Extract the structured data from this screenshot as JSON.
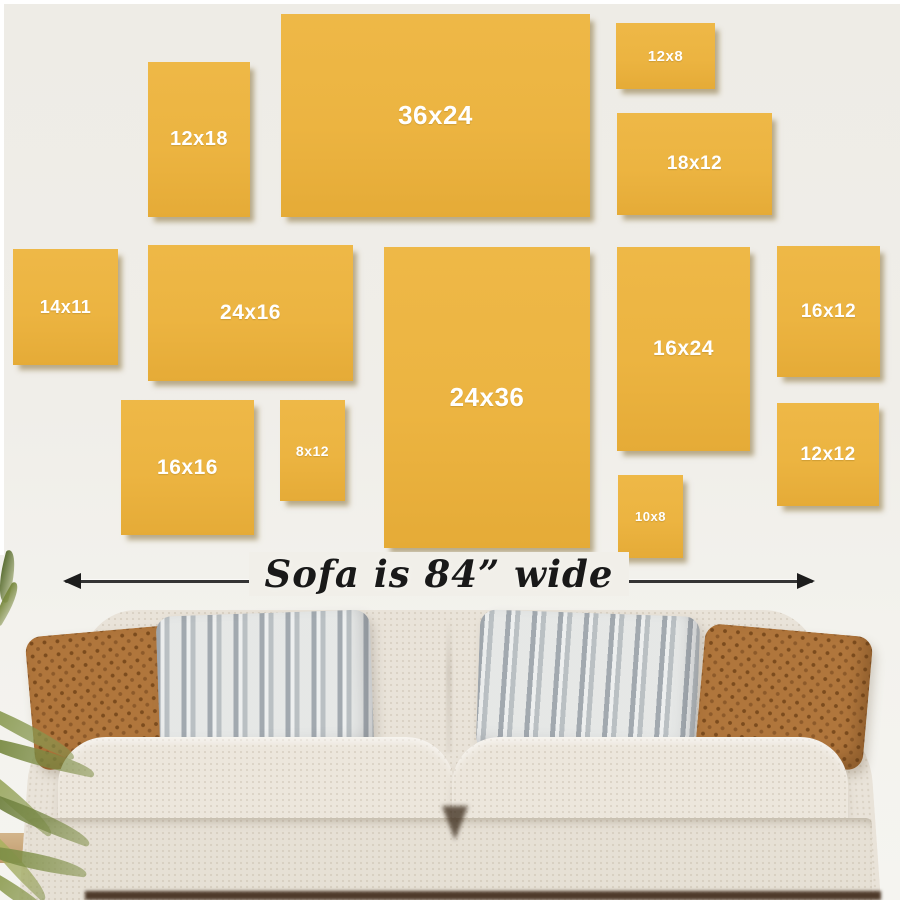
{
  "scene": {
    "description": "Wall art canvas size comparison guide above a sofa",
    "width_px": 900,
    "height_px": 900
  },
  "palette": {
    "wall": "#efede8",
    "frame_fill": "#ecb441",
    "frame_shadow": "rgba(128,102,40,0.5)",
    "label_color": "#ffffff",
    "arrow_color": "#1d1d1d",
    "caption_color": "#191919",
    "sofa_fabric": "#e9e3d9",
    "pillow_brown": "#b0763c",
    "pillow_gray": "#dadbd9",
    "plant_green": "#86974e",
    "floor_shadow": "#4e3a2a"
  },
  "frames": [
    {
      "label": "12x18",
      "x": 148,
      "y": 62,
      "w": 102,
      "h": 155,
      "font": 20
    },
    {
      "label": "36x24",
      "x": 281,
      "y": 14,
      "w": 309,
      "h": 203,
      "font": 26
    },
    {
      "label": "12x8",
      "x": 616,
      "y": 23,
      "w": 99,
      "h": 66,
      "font": 15
    },
    {
      "label": "18x12",
      "x": 617,
      "y": 113,
      "w": 155,
      "h": 102,
      "font": 19
    },
    {
      "label": "14x11",
      "x": 13,
      "y": 249,
      "w": 105,
      "h": 116,
      "font": 18
    },
    {
      "label": "24x16",
      "x": 148,
      "y": 245,
      "w": 205,
      "h": 136,
      "font": 21
    },
    {
      "label": "24x36",
      "x": 384,
      "y": 247,
      "w": 206,
      "h": 301,
      "font": 26
    },
    {
      "label": "16x24",
      "x": 617,
      "y": 247,
      "w": 133,
      "h": 204,
      "font": 21
    },
    {
      "label": "16x12",
      "x": 777,
      "y": 246,
      "w": 103,
      "h": 131,
      "font": 19
    },
    {
      "label": "16x16",
      "x": 121,
      "y": 400,
      "w": 133,
      "h": 135,
      "font": 21
    },
    {
      "label": "8x12",
      "x": 280,
      "y": 400,
      "w": 65,
      "h": 101,
      "font": 14
    },
    {
      "label": "10x8",
      "x": 618,
      "y": 475,
      "w": 65,
      "h": 83,
      "font": 13
    },
    {
      "label": "12x12",
      "x": 777,
      "y": 403,
      "w": 102,
      "h": 103,
      "font": 19
    }
  ],
  "caption": {
    "text": "Sofa is 84” wide"
  }
}
